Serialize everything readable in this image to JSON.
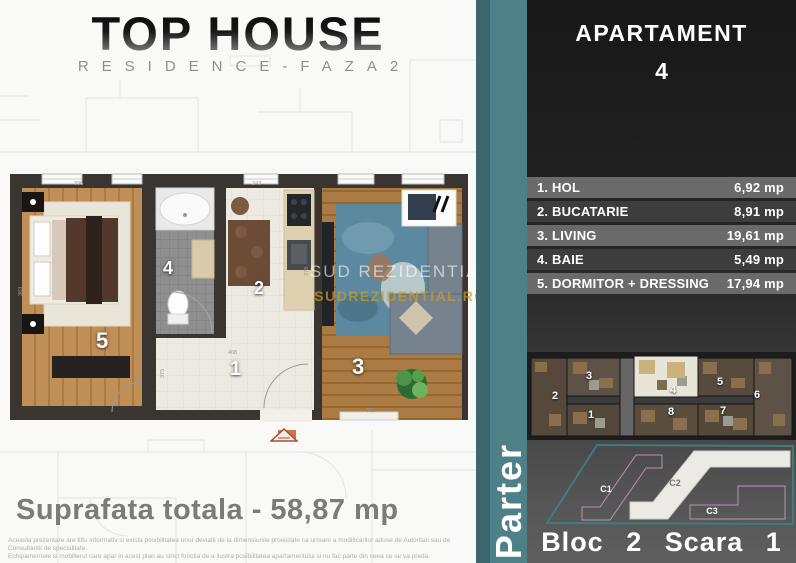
{
  "logo": {
    "title": "TOP HOUSE",
    "subtitle": "RESIDENCE-FAZA2"
  },
  "apartment": {
    "title": "APARTAMENT",
    "number": "4"
  },
  "rooms": [
    {
      "label": "1. HOL",
      "area": "6,92 mp"
    },
    {
      "label": "2. BUCATARIE",
      "area": "8,91 mp"
    },
    {
      "label": "3. LIVING",
      "area": "19,61 mp"
    },
    {
      "label": "4. BAIE",
      "area": "5,49 mp"
    },
    {
      "label": "5. DORMITOR + DRESSING",
      "area": "17,94 mp"
    }
  ],
  "floor_plan": {
    "room_numbers": {
      "bedroom": "5",
      "bathroom": "4",
      "kitchen": "2",
      "hall": "1",
      "living": "3"
    },
    "dimensions": {
      "bedroom_top": "335",
      "bedroom_left": "363",
      "kitchen_top": "243",
      "kitchen_right": "378",
      "hall_width": "408",
      "hall_height": "375",
      "living_bottom": "312"
    },
    "watermark": {
      "line1": "SUD REZIDENTIAL",
      "line2": "SUDREZIDENTIAL.RO"
    }
  },
  "total": {
    "label": "Suprafata totala - 58,87 mp"
  },
  "disclaimer": {
    "line1": "Aceasta prezentare are titlu informativ si exista posibilitatea unor deviatii de la dimensiunile proiectate ca urmare a modificarilor aduse de Autoritati sau de Consultantii de specialitate.",
    "line2": "Echipamentele si mobilierul care apar in acest plan au strict functia de a ilustra posibilitatea apartamentului si nu fac parte din ceea ce se va preda."
  },
  "floor": {
    "label": "Parter"
  },
  "overview": {
    "numbers": [
      "2",
      "3",
      "4",
      "5",
      "6",
      "1",
      "8",
      "7"
    ],
    "highlighted": "4"
  },
  "site_plan": {
    "labels": [
      "C1",
      "C2",
      "C3"
    ],
    "highlighted": "C2"
  },
  "bottom": {
    "label": "Bloc 2 Scara 1"
  },
  "colors": {
    "teal": "#4e8087",
    "teal_dark": "#3c686d",
    "panel_dark": "#1f1f1f",
    "row_light": "#6a6a6a",
    "row_dark": "#3d3d3d",
    "wall": "#3b3531",
    "wood_bedroom": "#c08f58",
    "wood_living": "#ab7b46",
    "rug_blue": "#5d89a0",
    "watermark_gold": "#c69e28",
    "highlight_unit": "#e9e4d8"
  }
}
